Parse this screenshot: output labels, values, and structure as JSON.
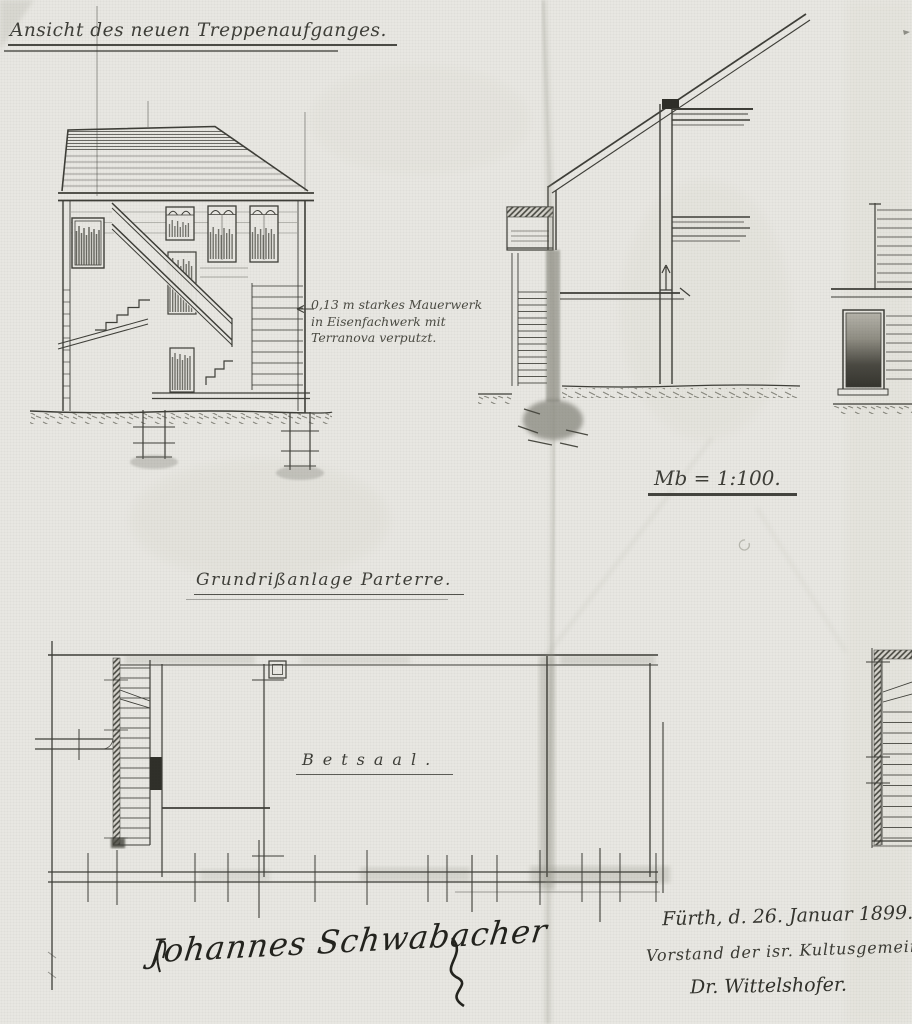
{
  "sheet": {
    "paper_color": "#e9e8e3",
    "ink_color": "#3e3e38",
    "pencil_color": "#8f8f85",
    "signature_ink": "#23231e"
  },
  "labels": {
    "elevation_title": "Ansicht des neuen Treppenaufganges.",
    "material_note_line1": "0,13 m starkes Mauerwerk",
    "material_note_line2": "in Eisenfachwerk mit",
    "material_note_line3": "Terranova verputzt.",
    "scale_note": "Mb = 1:100.",
    "plan_title": "Grundrißanlage Parterre.",
    "room_name": "Betsaal."
  },
  "approval": {
    "place_date": "Fürth, d. 26. Januar 1899.",
    "role": "Vorstand der isr. Kultusgemeinde",
    "signature": "Dr. Wittelshofer."
  },
  "builder_signature": {
    "name": "Johannes Schwabacher"
  }
}
